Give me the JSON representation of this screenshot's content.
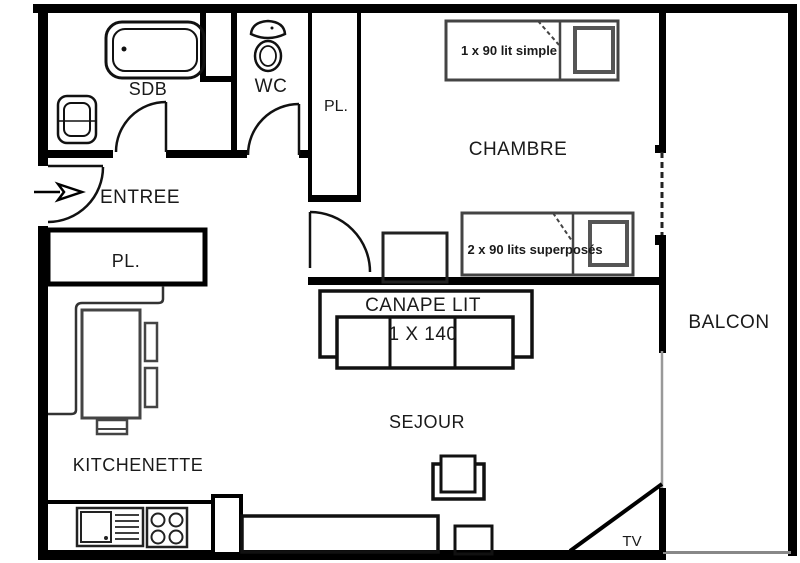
{
  "plan": {
    "rooms": {
      "sdb": {
        "label": "SDB"
      },
      "wc": {
        "label": "WC"
      },
      "closet_top": {
        "label": "PL."
      },
      "entree": {
        "label": "ENTREE"
      },
      "closet_entry": {
        "label": "PL."
      },
      "chambre": {
        "label": "CHAMBRE"
      },
      "balcon": {
        "label": "BALCON"
      },
      "kitchenette": {
        "label": "KITCHENETTE"
      },
      "sejour": {
        "label": "SEJOUR"
      },
      "tv_corner": {
        "label": "TV"
      }
    },
    "furniture": {
      "single_bed": {
        "label": "1 x 90 lit simple"
      },
      "bunk_beds": {
        "label": "2 x 90 lits superposés"
      },
      "sofa_bed": {
        "label": "CANAPE LIT",
        "size": "1 X 140"
      }
    },
    "colors": {
      "wall": "#000000",
      "furniture": "#3d3d3d",
      "pillow": "#555555",
      "glass": "#999999"
    }
  }
}
